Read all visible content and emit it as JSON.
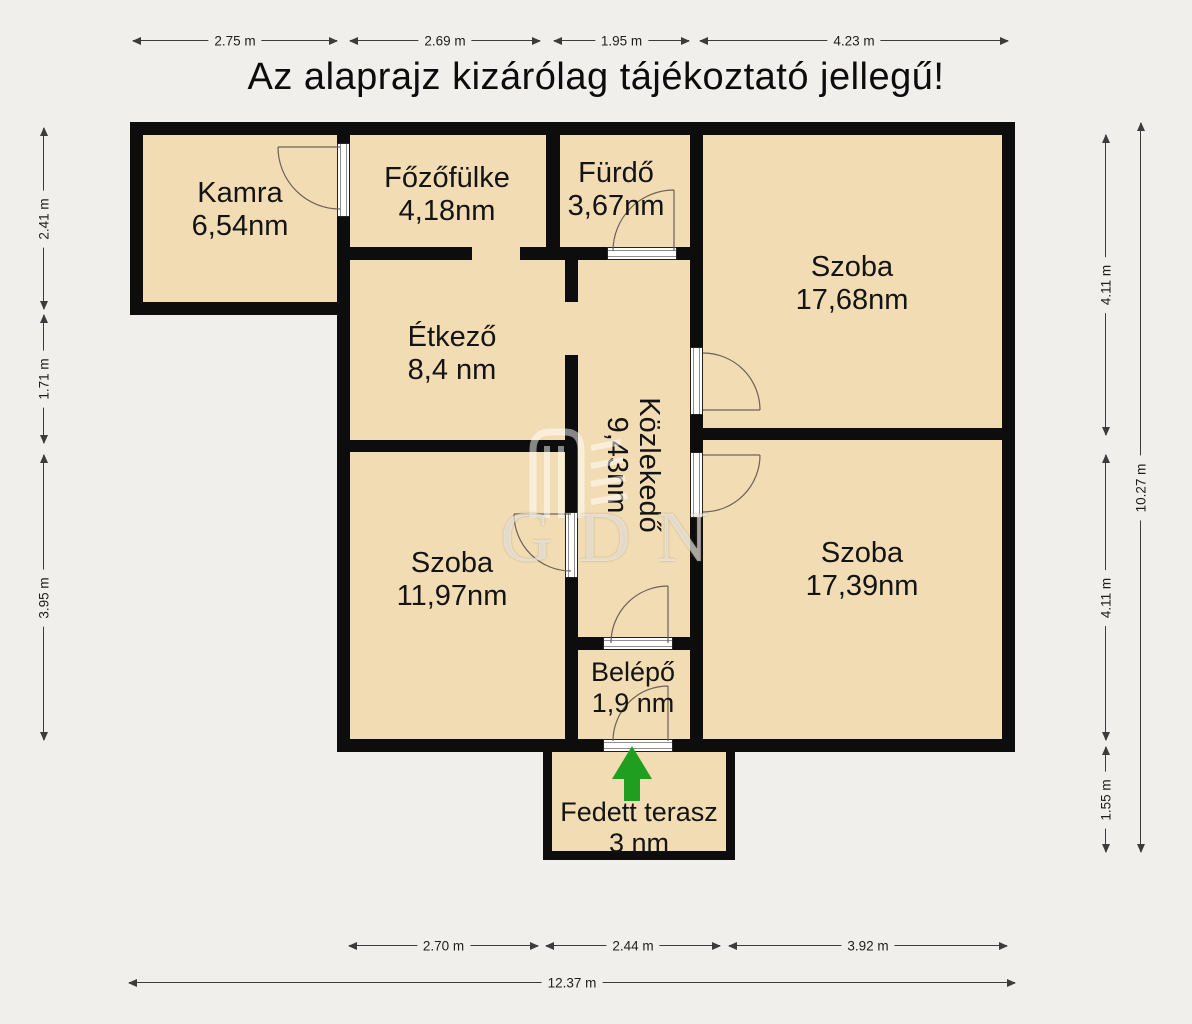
{
  "title": "Az alaprajz kizárólag tájékoztató jellegű!",
  "watermark": "GDN",
  "rooms": {
    "kamra": {
      "name": "Kamra",
      "area": "6,54nm"
    },
    "fozofulke": {
      "name": "Főzőfülke",
      "area": "4,18nm"
    },
    "furdo": {
      "name": "Fürdő",
      "area": "3,67nm"
    },
    "szoba_nagy": {
      "name": "Szoba",
      "area": "17,68nm"
    },
    "etkezo": {
      "name": "Étkező",
      "area": "8,4 nm"
    },
    "kozlekedo": {
      "name": "Közlekedő",
      "area": "9,43nm"
    },
    "szoba_bal": {
      "name": "Szoba",
      "area": "11,97nm"
    },
    "szoba_jobb": {
      "name": "Szoba",
      "area": "17,39nm"
    },
    "belepo": {
      "name": "Belépő",
      "area": "1,9 nm"
    },
    "terasz": {
      "name": "Fedett terasz",
      "area": "3 nm"
    }
  },
  "dimensions": {
    "top": [
      "2.75 m",
      "2.69 m",
      "1.95 m",
      "4.23 m"
    ],
    "left": [
      "2.41 m",
      "1.71 m",
      "3.95 m"
    ],
    "right_inner": [
      "4.11 m",
      "4.11 m",
      "1.55 m"
    ],
    "right_total": "10.27 m",
    "bottom": [
      "2.70 m",
      "2.44 m",
      "3.92 m"
    ],
    "bottom_total": "12.37 m"
  },
  "colors": {
    "room_fill": "#f2dcb3",
    "wall": "#0d0d0d",
    "background": "#f0efeb",
    "entrance_arrow_green": "#1f9e1f",
    "watermark": "rgba(255,255,255,0.55)"
  }
}
